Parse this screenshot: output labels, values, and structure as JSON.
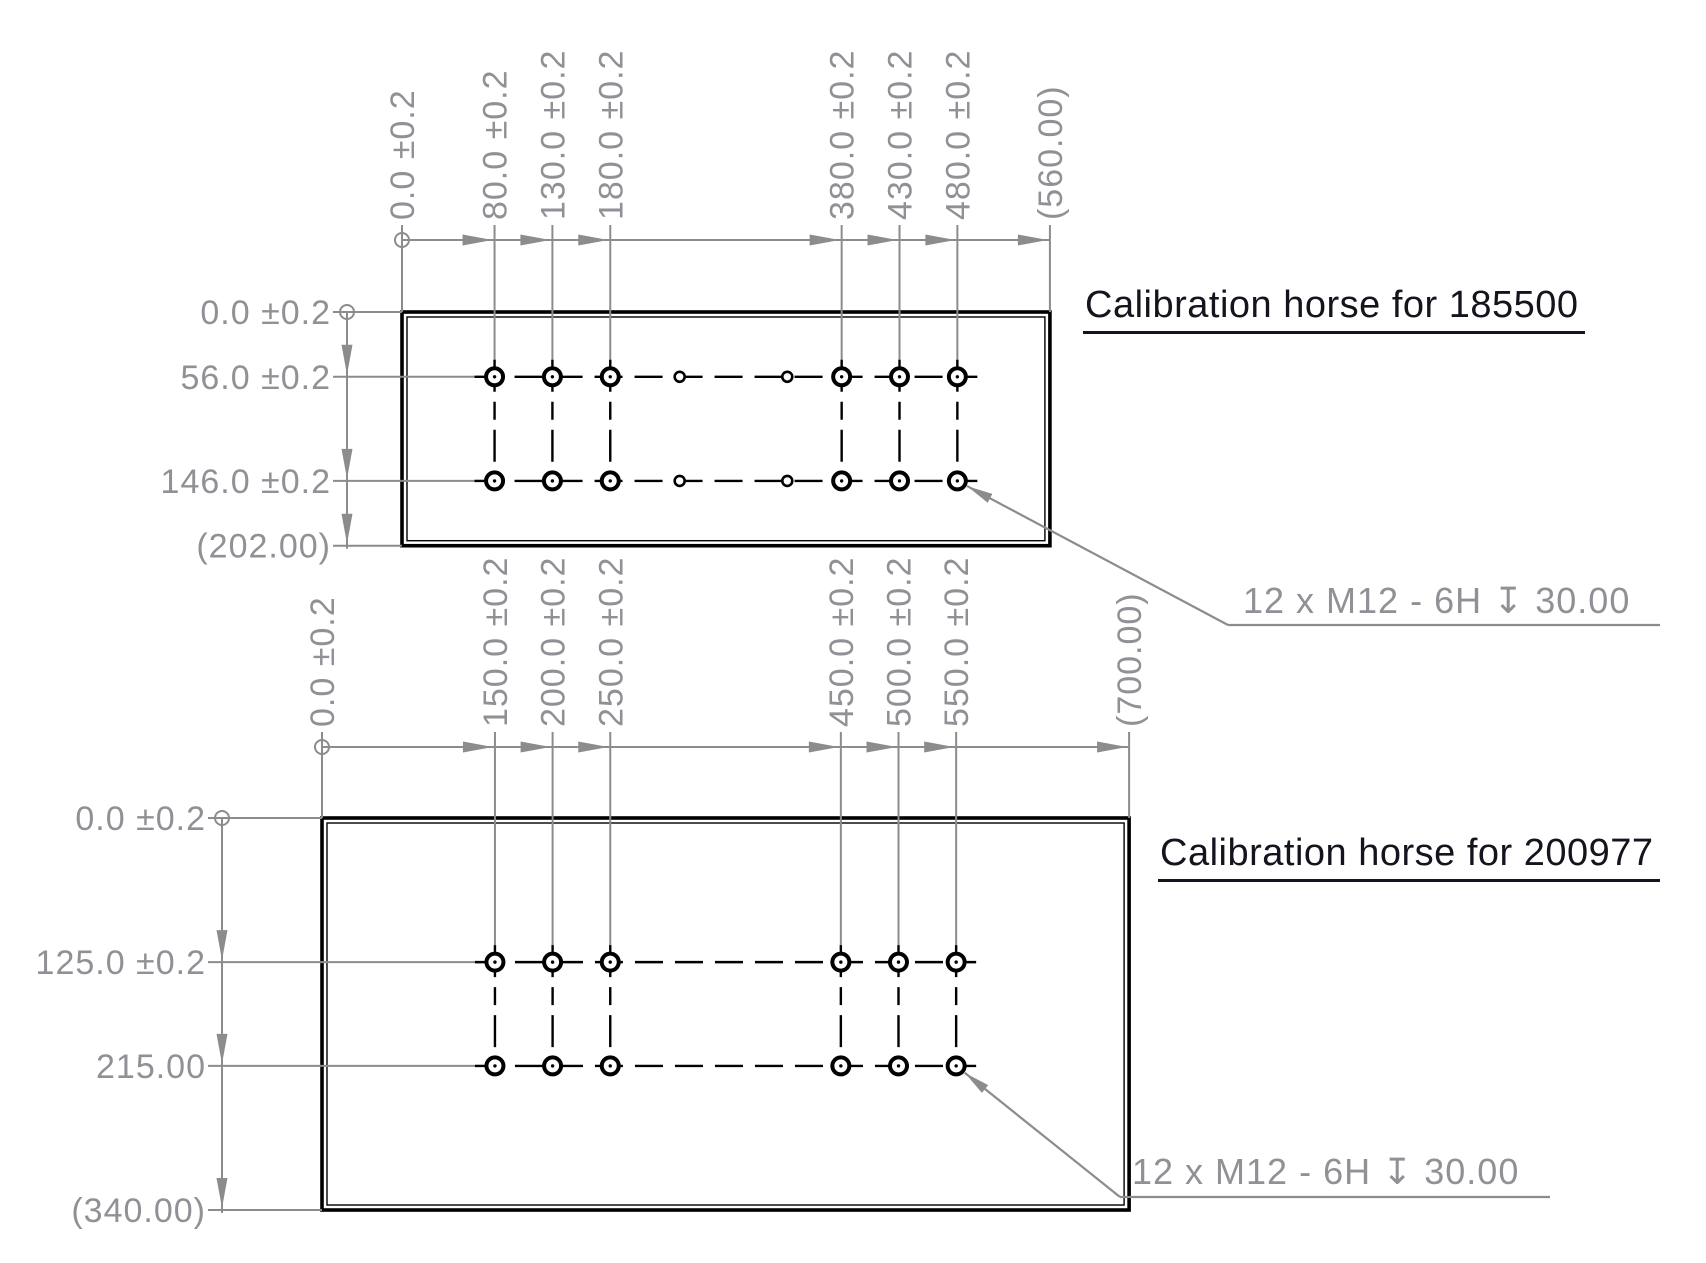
{
  "colors": {
    "background": "#ffffff",
    "outline": "#000000",
    "dim": "#8c8c8c",
    "dim_text": "#8f9196",
    "title": "#14141e"
  },
  "drawings": [
    {
      "title": "Calibration horse for 185500",
      "callout": "12 x M12 - 6H ↧ 30.00",
      "plate": {
        "width_mm": 560,
        "height_mm": 202
      },
      "x_dims": [
        {
          "label": "0.0 ±0.2",
          "mm": 0
        },
        {
          "label": "80.0 ±0.2",
          "mm": 80
        },
        {
          "label": "130.0 ±0.2",
          "mm": 130
        },
        {
          "label": "180.0 ±0.2",
          "mm": 180
        },
        {
          "label": "380.0 ±0.2",
          "mm": 380
        },
        {
          "label": "430.0 ±0.2",
          "mm": 430
        },
        {
          "label": "480.0 ±0.2",
          "mm": 480
        },
        {
          "label": "(560.00)",
          "mm": 560,
          "reference": true
        }
      ],
      "y_dims": [
        {
          "label": "0.0 ±0.2",
          "mm": 0
        },
        {
          "label": "56.0 ±0.2",
          "mm": 56
        },
        {
          "label": "146.0 ±0.2",
          "mm": 146
        },
        {
          "label": "(202.00)",
          "mm": 202,
          "reference": true
        }
      ],
      "holes": {
        "cols_mm": [
          80,
          130,
          180,
          380,
          430,
          480
        ],
        "rows_mm": [
          56,
          146
        ],
        "small_cols_mm": [
          240,
          333
        ]
      },
      "layout": {
        "origin": {
          "x": 402,
          "y": 312
        },
        "scale": 1.157,
        "dim_offset": 72,
        "left_dim_offset": 55,
        "callout": {
          "arrow_at": {
            "mm_x": 480,
            "mm_y": 146
          },
          "elbow": {
            "x": 1228,
            "y": 625
          },
          "shelf_x2": 1660
        }
      }
    },
    {
      "title": "Calibration horse for 200977",
      "callout": "12 x M12 - 6H ↧ 30.00",
      "plate": {
        "width_mm": 700,
        "height_mm": 340
      },
      "x_dims": [
        {
          "label": "0.0 ±0.2",
          "mm": 0
        },
        {
          "label": "150.0 ±0.2",
          "mm": 150
        },
        {
          "label": "200.0 ±0.2",
          "mm": 200
        },
        {
          "label": "250.0 ±0.2",
          "mm": 250
        },
        {
          "label": "450.0 ±0.2",
          "mm": 450
        },
        {
          "label": "500.0 ±0.2",
          "mm": 500
        },
        {
          "label": "550.0 ±0.2",
          "mm": 550
        },
        {
          "label": "(700.00)",
          "mm": 700,
          "reference": true
        }
      ],
      "y_dims": [
        {
          "label": "0.0 ±0.2",
          "mm": 0
        },
        {
          "label": "125.0 ±0.2",
          "mm": 125
        },
        {
          "label": "215.00",
          "mm": 215
        },
        {
          "label": "(340.00)",
          "mm": 340,
          "reference": true
        }
      ],
      "holes": {
        "cols_mm": [
          150,
          200,
          250,
          450,
          500,
          550
        ],
        "rows_mm": [
          125,
          215
        ],
        "small_cols_mm": []
      },
      "layout": {
        "origin": {
          "x": 322,
          "y": 818
        },
        "scale": 1.153,
        "dim_offset": 71,
        "left_dim_offset": 100,
        "callout": {
          "arrow_at": {
            "mm_x": 550,
            "mm_y": 215
          },
          "elbow": {
            "x": 1120,
            "y": 1197
          },
          "shelf_x2": 1550
        }
      }
    }
  ]
}
